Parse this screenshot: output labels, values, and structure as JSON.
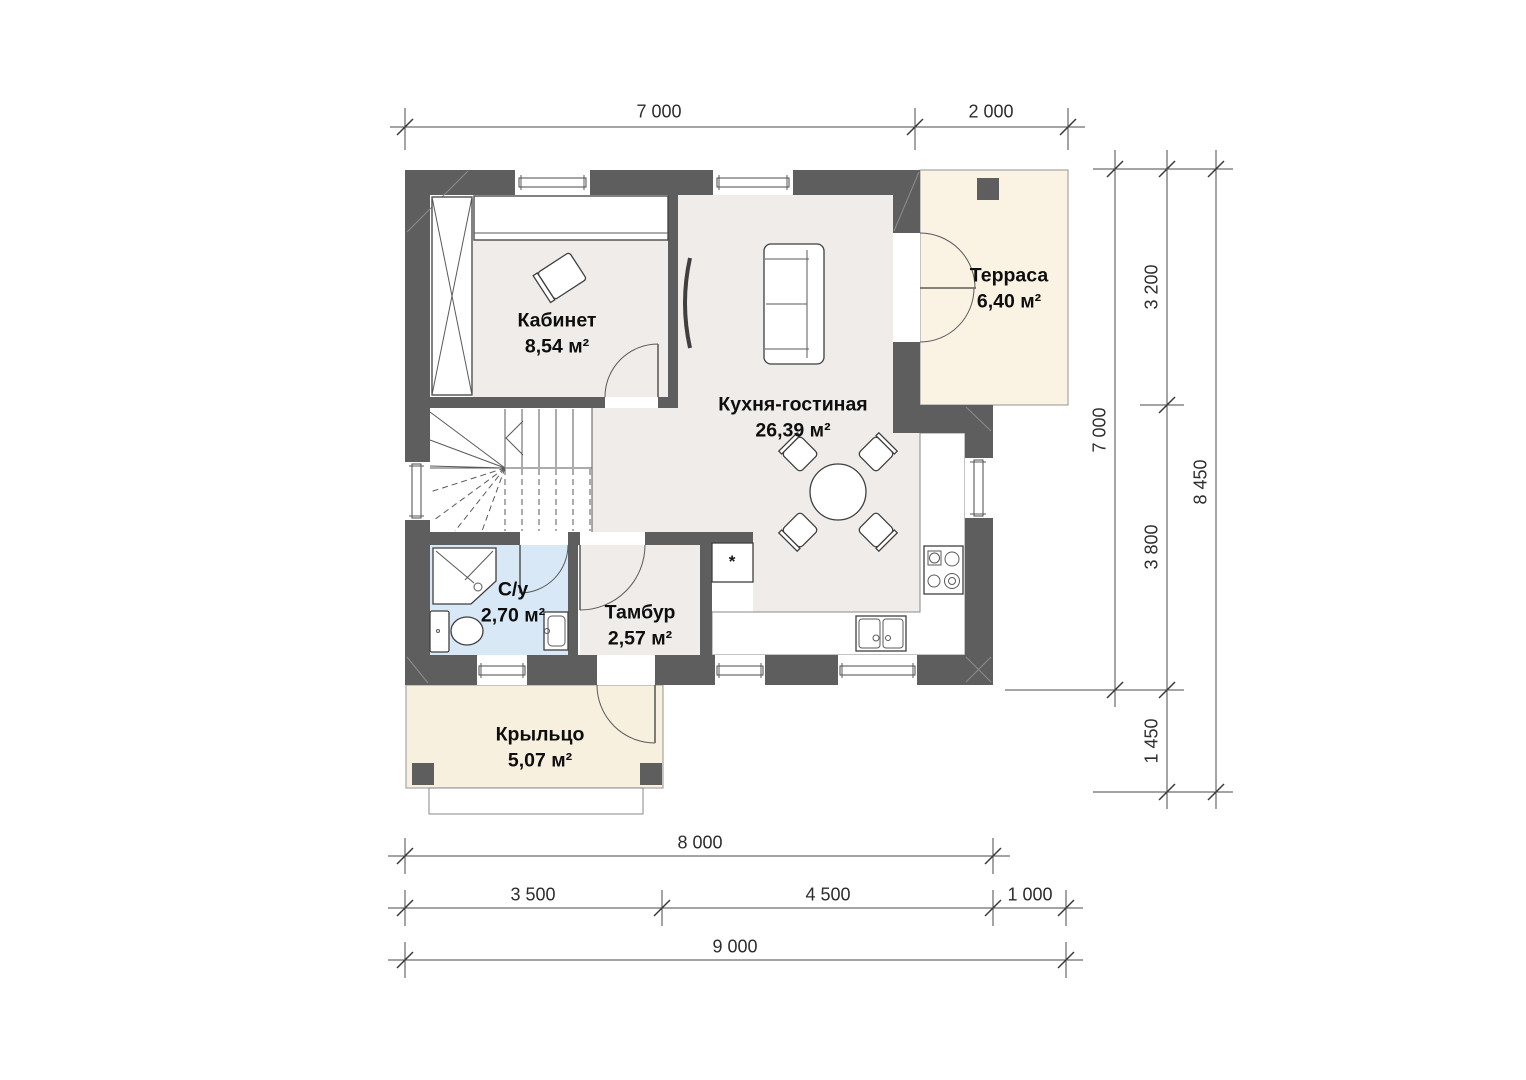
{
  "colors": {
    "wall": "#5e5e5e",
    "floor": "#efece9",
    "bathroom_floor": "#d8e8f6",
    "terrace_floor": "#faf2e3",
    "porch_floor": "#f7f0de"
  },
  "rooms": [
    {
      "id": "kabinet",
      "name": "Кабинет",
      "area": "8,54 м²"
    },
    {
      "id": "kitchen-living",
      "name": "Кухня-гостиная",
      "area": "26,39 м²"
    },
    {
      "id": "terrace",
      "name": "Терраса",
      "area": "6,40 м²"
    },
    {
      "id": "bathroom",
      "name": "С/у",
      "area": "2,70 м²"
    },
    {
      "id": "tambour",
      "name": "Тамбур",
      "area": "2,57 м²"
    },
    {
      "id": "porch",
      "name": "Крыльцо",
      "area": "5,07 м²"
    }
  ],
  "symbols": {
    "fridge": "*"
  },
  "dimensions": {
    "top": [
      "7 000",
      "2 000"
    ],
    "right_total": "7 000",
    "right_segments": [
      "3 200",
      "3 800",
      "1 450"
    ],
    "right_overall": "8 450",
    "bottom_main": "8 000",
    "bottom_segments": [
      "3 500",
      "4 500",
      "1 000"
    ],
    "bottom_overall": "9 000"
  }
}
